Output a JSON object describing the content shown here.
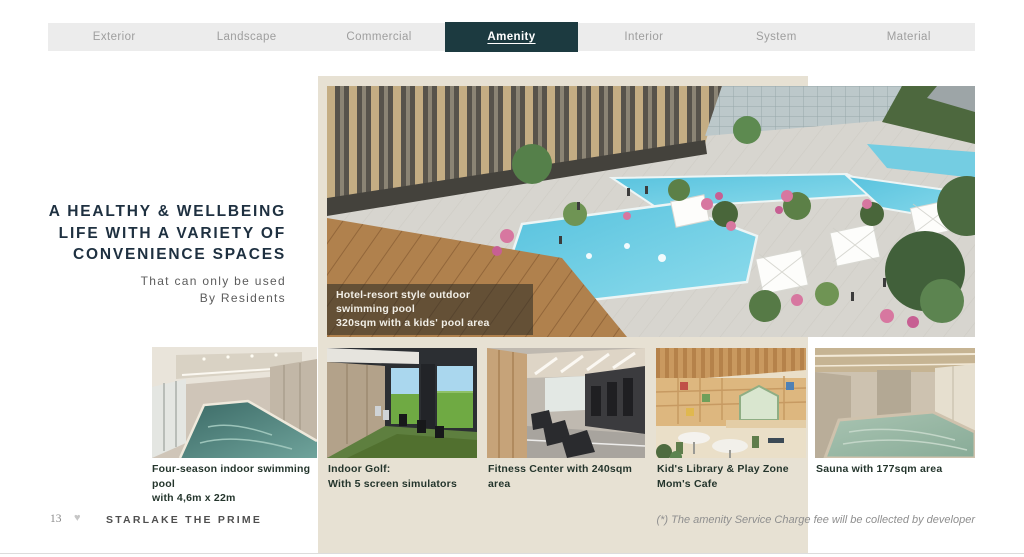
{
  "tabs": {
    "items": [
      {
        "label": "Exterior",
        "active": false
      },
      {
        "label": "Landscape",
        "active": false
      },
      {
        "label": "Commercial",
        "active": false
      },
      {
        "label": "Amenity",
        "active": true
      },
      {
        "label": "Interior",
        "active": false
      },
      {
        "label": "System",
        "active": false
      },
      {
        "label": "Material",
        "active": false
      }
    ]
  },
  "headline": {
    "line1": "A HEALTHY & WELLBEING",
    "line2": "LIFE WITH A VARIETY OF",
    "line3": "CONVENIENCE SPACES",
    "subtitle1": "That can only be used",
    "subtitle2": "By Residents"
  },
  "main_image": {
    "caption_line1": "Hotel-resort style outdoor swimming pool",
    "caption_line2": "320sqm with a kids' pool area"
  },
  "thumbnails": [
    {
      "caption_line1": "Four-season indoor swimming pool",
      "caption_line2": "with 4,6m x 22m"
    },
    {
      "caption_line1": "Indoor Golf:",
      "caption_line2": "With 5 screen simulators"
    },
    {
      "caption_line1": "Fitness Center with 240sqm area",
      "caption_line2": ""
    },
    {
      "caption_line1": "Kid's Library & Play Zone",
      "caption_line2": "Mom's Cafe"
    },
    {
      "caption_line1": "Sauna with 177sqm area",
      "caption_line2": ""
    }
  ],
  "footer": {
    "page_number": "13",
    "brand": "STARLAKE THE PRIME",
    "note": "(*) The amenity Service Charge fee will be collected by developer"
  },
  "icons": {
    "footer_heart_glyph": "♥"
  },
  "colors": {
    "accent_dark_teal": "#1c3a40",
    "panel_beige": "#e7e1d3",
    "tab_bar_gray": "#ececec",
    "headline_navy": "#1e3040",
    "caption_green": "#24352c",
    "pool_water": "#57c2de"
  }
}
